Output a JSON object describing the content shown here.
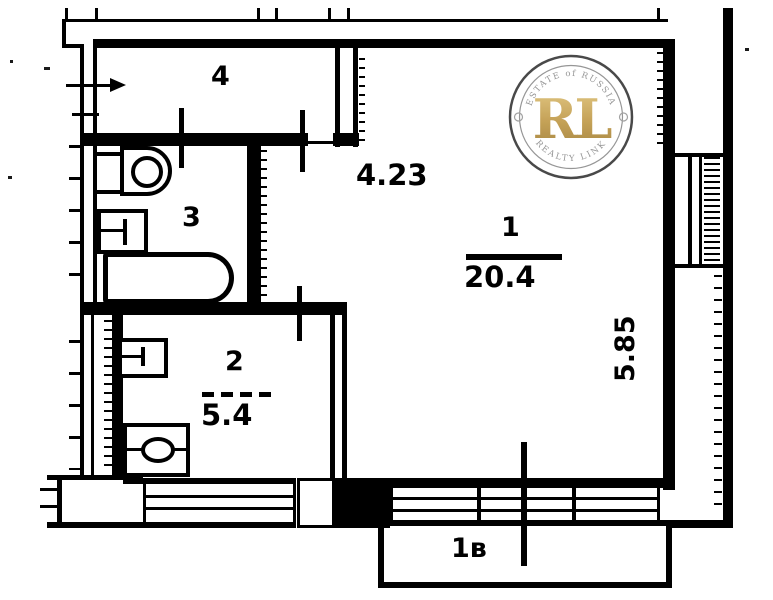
{
  "watermark": {
    "monogram": "RL",
    "arc_top": "ESTATE of RUSSIA",
    "arc_bottom": "REALTY LINK"
  },
  "rooms": {
    "hallway": {
      "number": "4"
    },
    "bathroom": {
      "number": "3"
    },
    "living": {
      "number": "1",
      "area": "20.4"
    },
    "kitchen": {
      "number": "2",
      "area": "5.4"
    },
    "balcony": {
      "label": "1в"
    }
  },
  "dimensions": {
    "living_width": "4.23",
    "living_depth": "5.85"
  },
  "colors": {
    "ink": "#000000",
    "paper": "#ffffff",
    "logo_gold": "#c09a4a",
    "logo_ring": "#3c3c3c",
    "logo_gray_text": "#8f8f8f"
  }
}
